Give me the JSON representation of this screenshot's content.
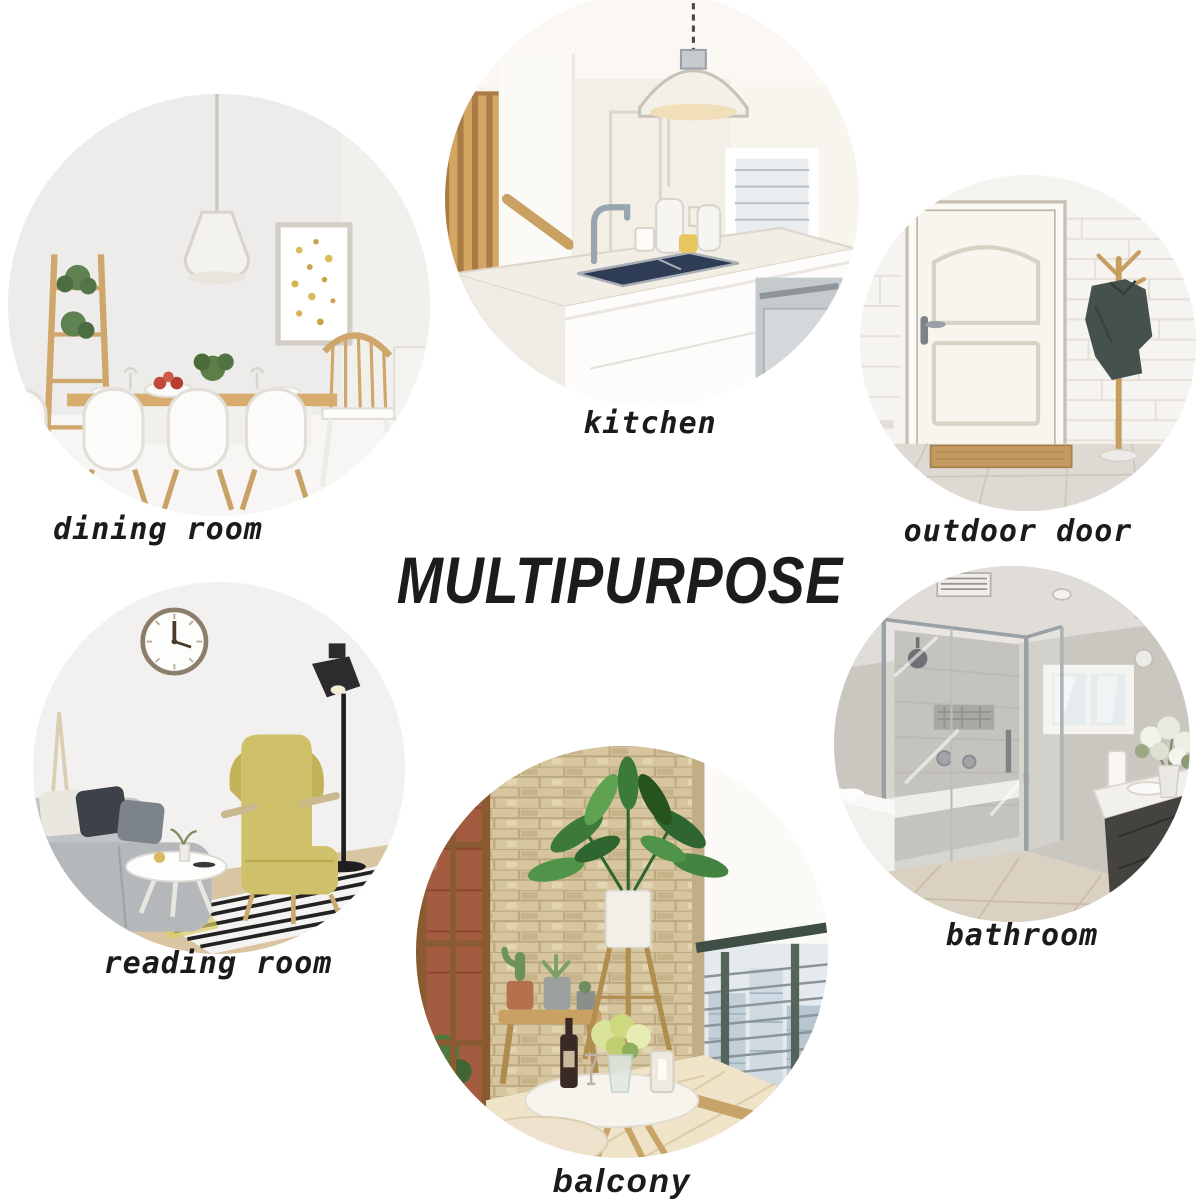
{
  "title": {
    "text": "MULTIPURPOSE"
  },
  "rooms": {
    "dining": {
      "label": "dining room",
      "alt": "bright dining room with wooden table, white shell chairs, pendant lamp, ladder shelf with plants and gold-dot wall art"
    },
    "kitchen": {
      "label": "kitchen",
      "alt": "white kitchen island with navy undermount sink, chrome faucet, dome pendant lamp on chain, wooden stair rail and window"
    },
    "outdoor_door": {
      "label": "outdoor door",
      "alt": "white panel entry door on white brick wall, wooden coat stand with dark jacket and tan doormat"
    },
    "reading": {
      "label": "reading room",
      "alt": "reading corner with wall clock, black floor lamp, mustard wing chair with footrest, grey sofa, round white table and striped rug"
    },
    "balcony": {
      "label": "balcony",
      "alt": "balcony with stone wall, wooden plant stand with large green plant, cactus pots on bench, round table with flowers and wine, stools and cable railing with city view"
    },
    "bathroom": {
      "label": "bathroom",
      "alt": "grey bathroom with glass walk-in shower, small white window, dark vanity with white counter and white flowers"
    }
  },
  "colors": {
    "background": "#ffffff",
    "text": "#1b1b1b",
    "wood": "#c9a066",
    "sink_navy": "#2e3c55",
    "chair_mustard": "#cfc06a",
    "jacket_green_grey": "#45514c",
    "stone_wall": "#d6c59e",
    "railing_green": "#4a5a50",
    "bathroom_grey": "#cac7c1"
  }
}
